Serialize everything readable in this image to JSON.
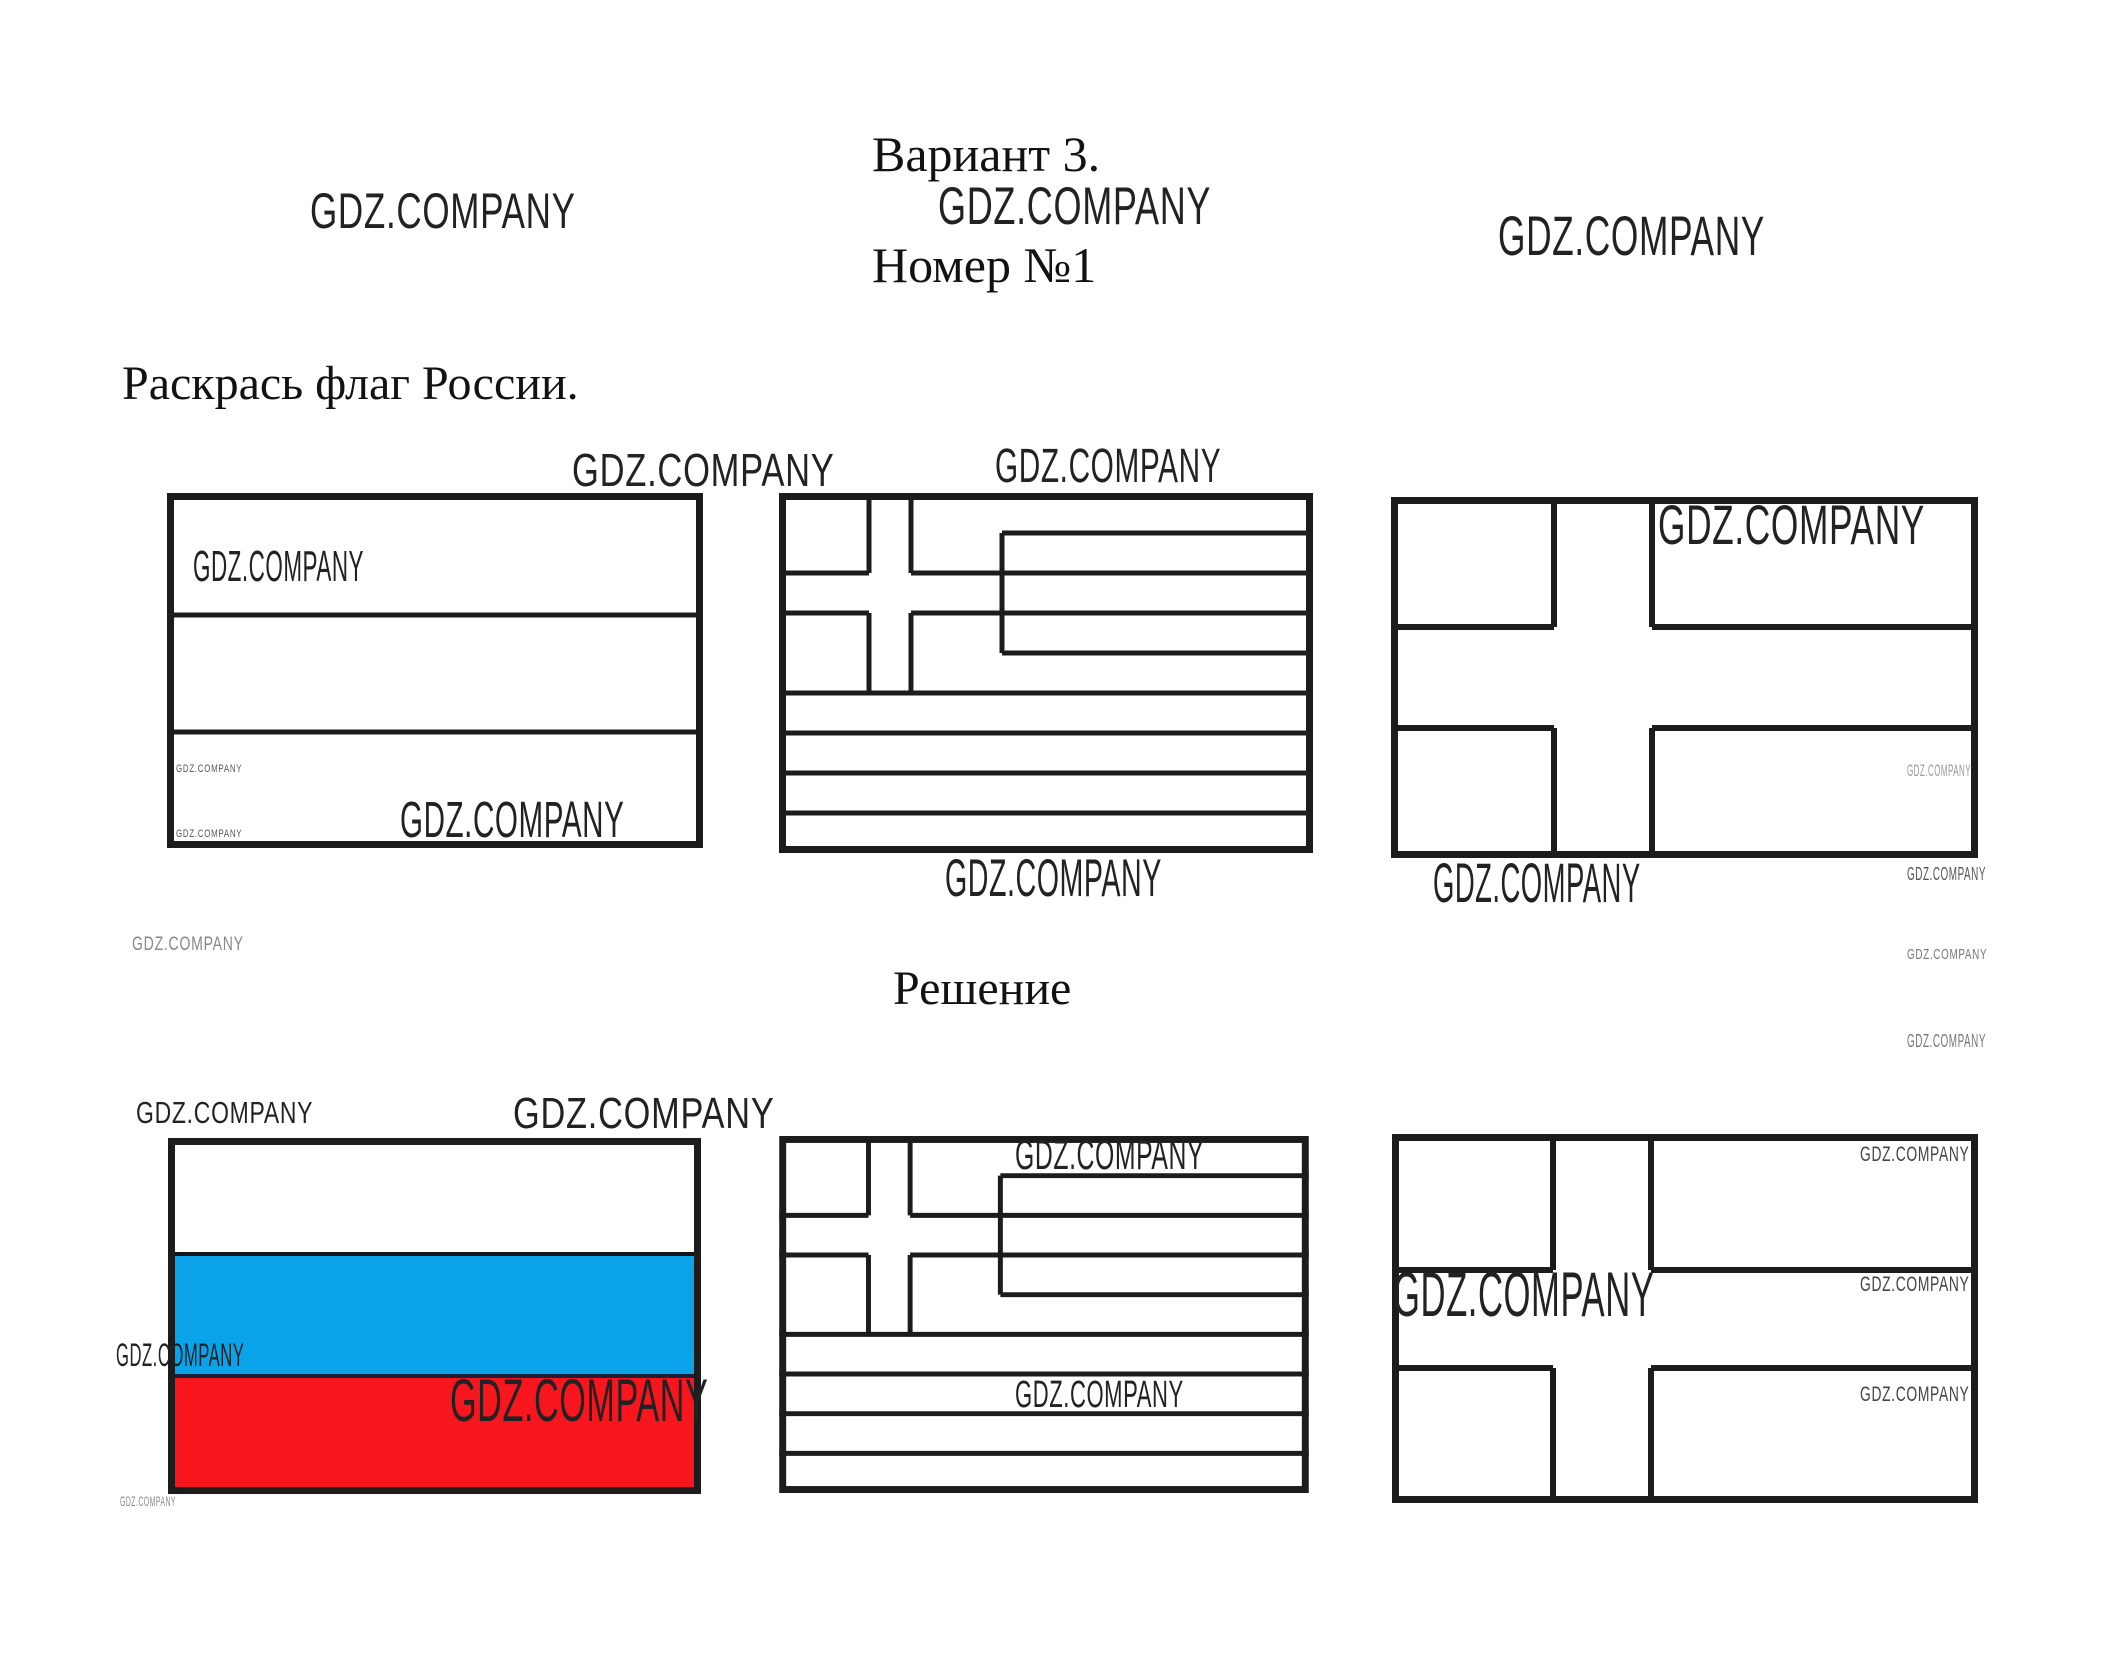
{
  "page": {
    "variant_title": "Вариант 3.",
    "task_number": "Номер №1",
    "instruction": "Раскрась флаг России.",
    "solution_heading": "Решение"
  },
  "watermark": "GDZ.COMPANY",
  "flags": {
    "task_row": [
      {
        "name": "russia-flag-outline"
      },
      {
        "name": "greece-flag-outline"
      },
      {
        "name": "nordic-cross-flag-outline"
      }
    ],
    "solution_row": [
      {
        "name": "russia-flag-colored",
        "bands": [
          {
            "color_name": "white",
            "hex": "#FFFFFF"
          },
          {
            "color_name": "blue",
            "hex": "#0AA2E8"
          },
          {
            "color_name": "red",
            "hex": "#F8161E"
          }
        ]
      },
      {
        "name": "greece-flag-outline"
      },
      {
        "name": "nordic-cross-flag-outline"
      }
    ],
    "outline_color": "#1C1C1C"
  }
}
